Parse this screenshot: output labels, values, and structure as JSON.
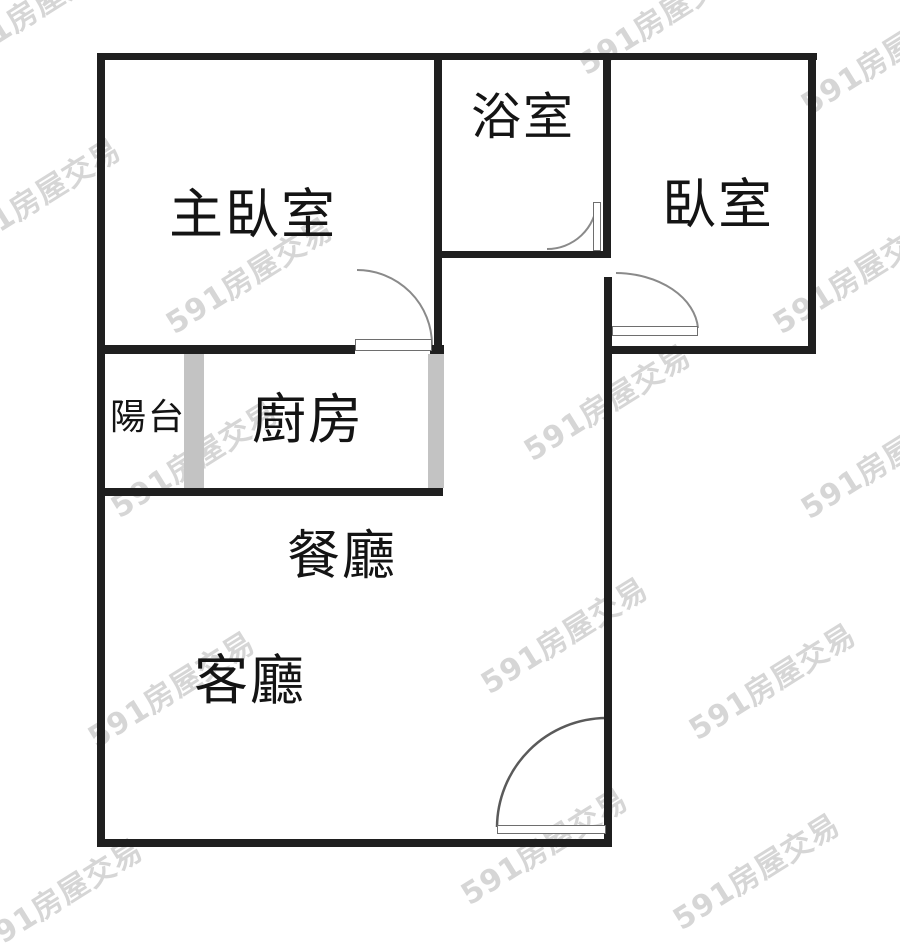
{
  "floorplan": {
    "rooms": [
      {
        "id": "master-bedroom",
        "label": "主臥室"
      },
      {
        "id": "bathroom",
        "label": "浴室"
      },
      {
        "id": "bedroom",
        "label": "臥室"
      },
      {
        "id": "balcony",
        "label": "陽台"
      },
      {
        "id": "kitchen",
        "label": "廚房"
      },
      {
        "id": "dining-room",
        "label": "餐廳"
      },
      {
        "id": "living-room",
        "label": "客廳"
      }
    ],
    "watermark": {
      "text": "591房屋交易",
      "color": "#d6d6d6"
    },
    "colors": {
      "wall": "#1f1f1f",
      "window_bar": "#c3c3c3",
      "door_arc": "#8a8a8a",
      "background": "#ffffff"
    }
  }
}
